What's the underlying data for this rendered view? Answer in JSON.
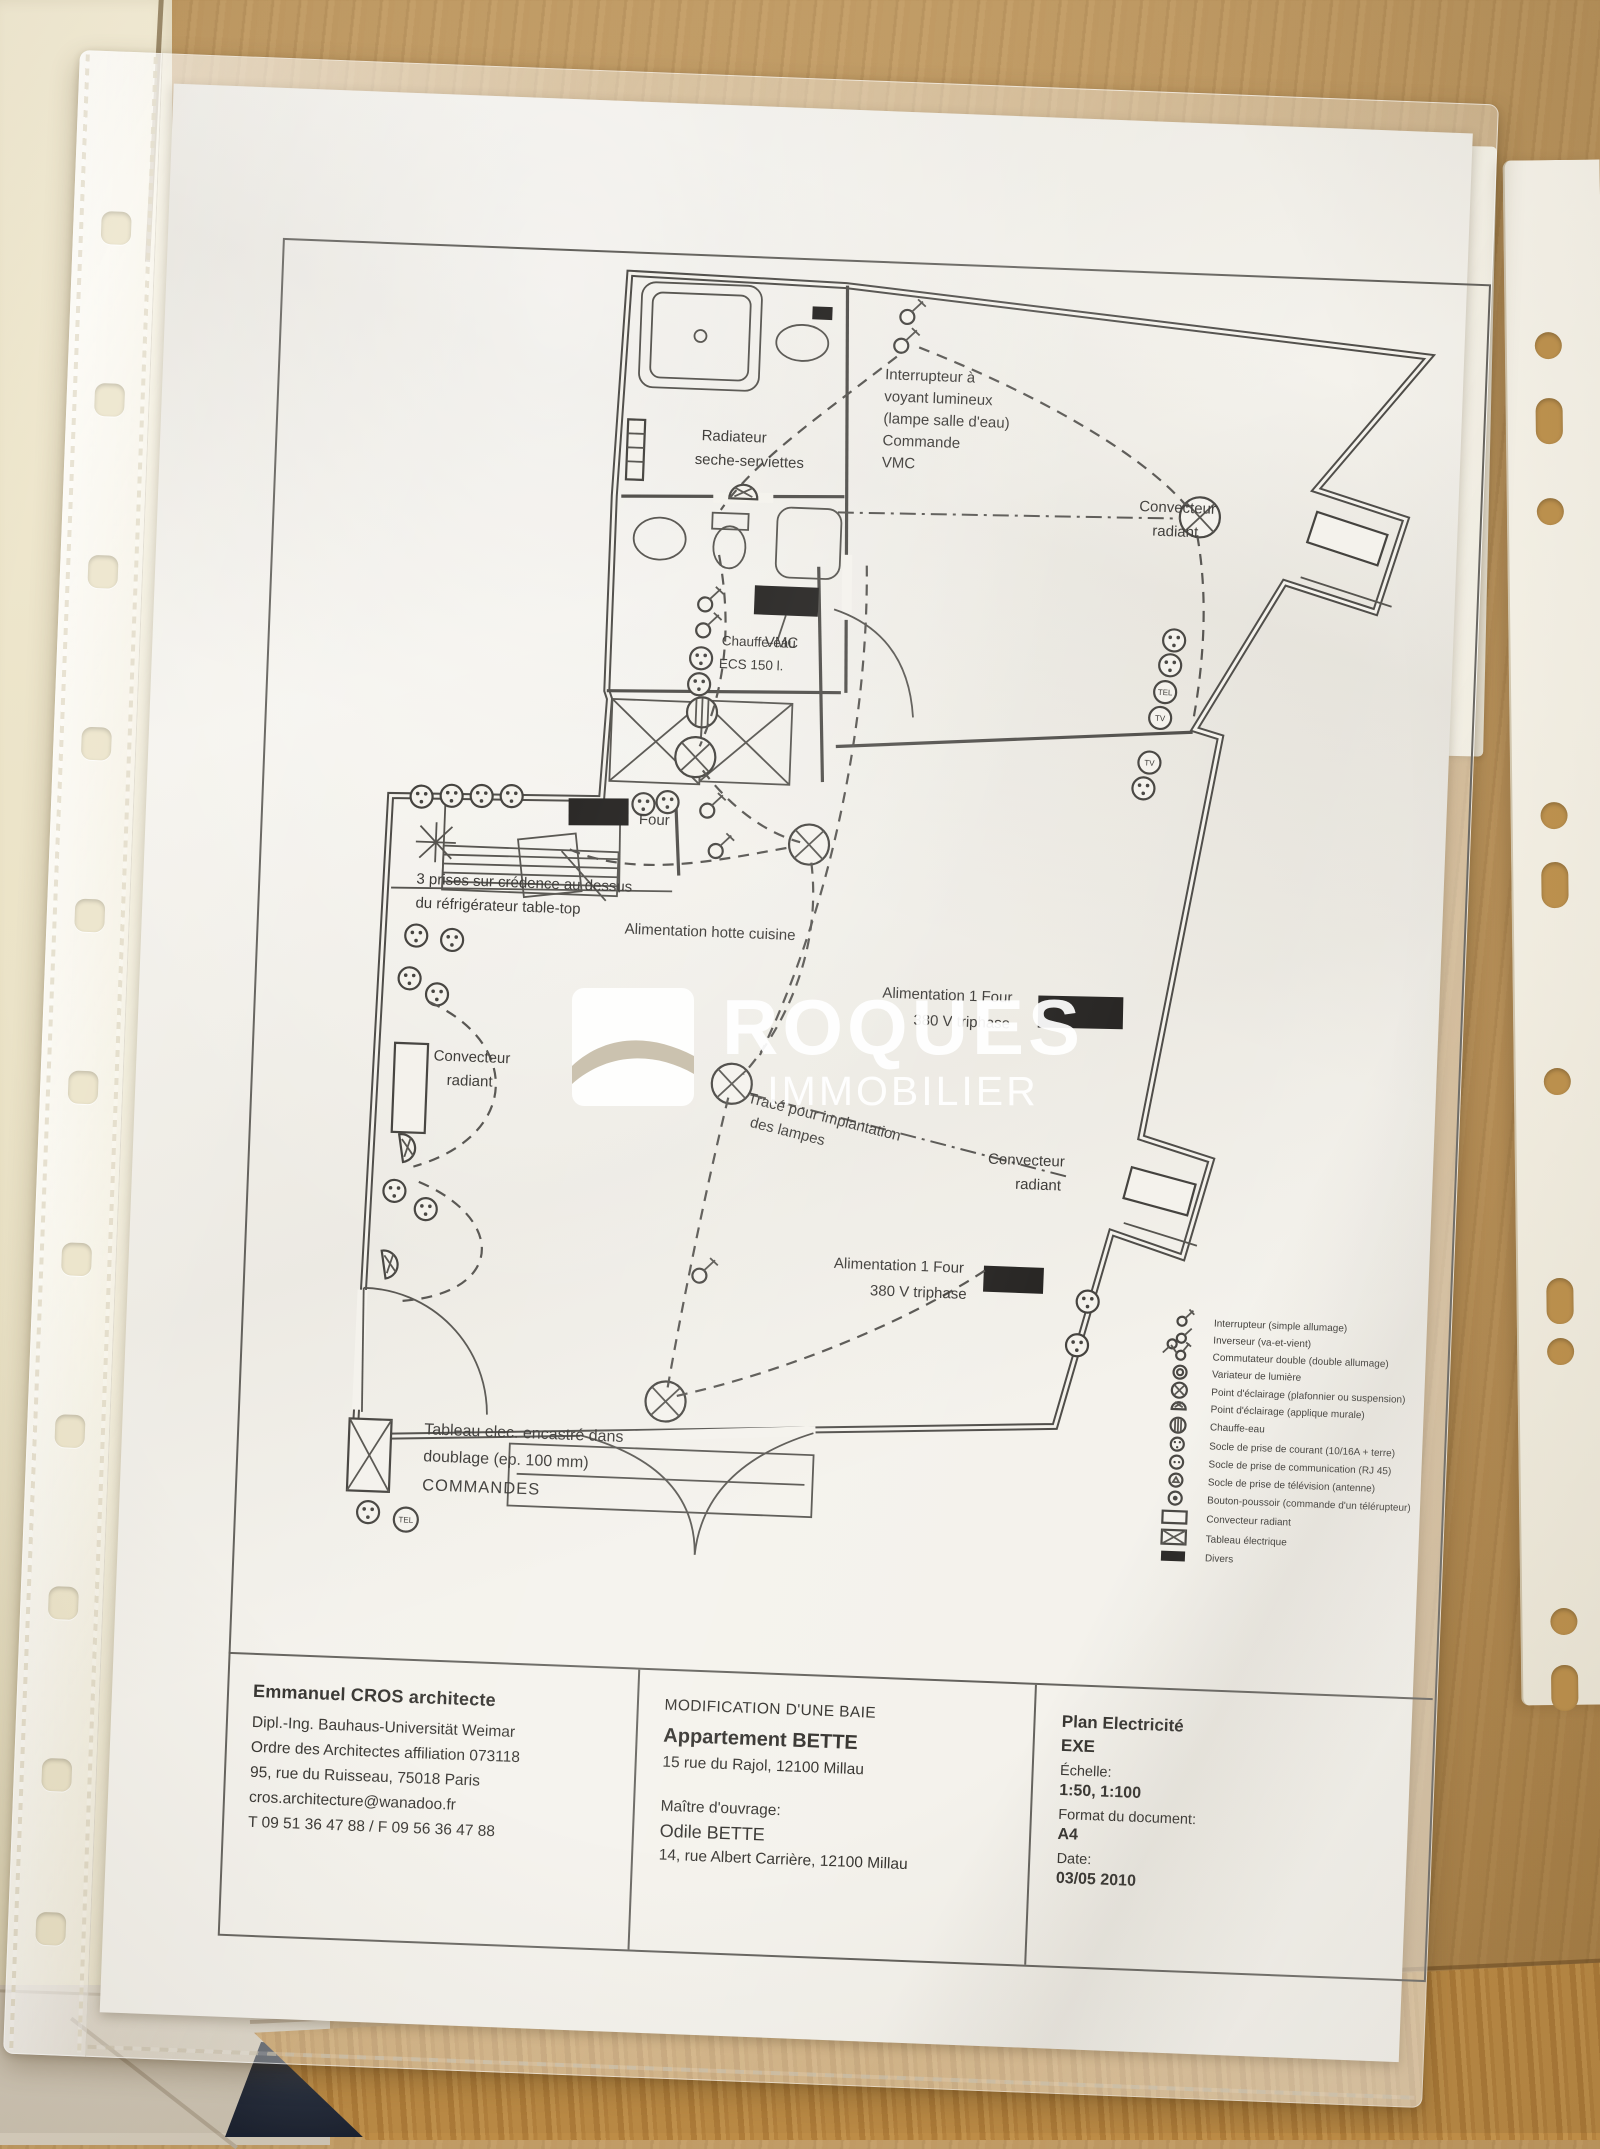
{
  "watermark": {
    "line1": "ROQUES",
    "line2": "IMMOBILIER"
  },
  "plan": {
    "labels": {
      "interrupteur_voyant": [
        "Interrupteur à",
        "voyant lumineux",
        "(lampe salle d'eau)",
        "Commande",
        "VMC"
      ],
      "radiateur": [
        "Radiateur",
        "seche-serviettes"
      ],
      "convecteur_top_right": [
        "Convecteur",
        "radiant"
      ],
      "vmc": "VMC",
      "chauffe_eau": [
        "Chauffe-eau",
        "ECS 150 l."
      ],
      "four": "Four",
      "prises_credence": [
        "3 prises sur crédence au dessus",
        "du réfrigérateur table-top"
      ],
      "hotte": "Alimentation hotte cuisine",
      "alim_four_1": [
        "Alimentation 1 Four",
        "380 V triphase"
      ],
      "convecteur_left": [
        "Convecteur",
        "radiant"
      ],
      "trace_lampes": [
        "Tracé pour implantation",
        "des lampes"
      ],
      "convecteur_mid_right": [
        "Convecteur",
        "radiant"
      ],
      "alim_four_2": [
        "Alimentation 1 Four",
        "380 V triphase"
      ],
      "tableau_elec": [
        "Tableau elec. encastré dans",
        "doublage (ep. 100 mm)",
        "COMMANDES"
      ],
      "tel": "TEL",
      "tv": "TV"
    }
  },
  "legend": {
    "items": [
      {
        "symbol": "interrupteur-simple",
        "label": "Interrupteur (simple allumage)"
      },
      {
        "symbol": "inverseur",
        "label": "Inverseur (va-et-vient)"
      },
      {
        "symbol": "commutateur-double",
        "label": "Commutateur double (double allumage)"
      },
      {
        "symbol": "variateur",
        "label": "Variateur de lumière"
      },
      {
        "symbol": "point-eclairage-plafonnier",
        "label": "Point d'éclairage (plafonnier ou suspension)"
      },
      {
        "symbol": "point-eclairage-applique",
        "label": "Point d'éclairage (applique murale)"
      },
      {
        "symbol": "chauffe-eau",
        "label": "Chauffe-eau"
      },
      {
        "symbol": "prise-courant",
        "label": "Socle de prise de courant (10/16A + terre)"
      },
      {
        "symbol": "prise-communication",
        "label": "Socle de prise de communication (RJ 45)"
      },
      {
        "symbol": "prise-television",
        "label": "Socle de prise de télévision (antenne)"
      },
      {
        "symbol": "bouton-poussoir",
        "label": "Bouton-poussoir (commande d'un télérupteur)"
      },
      {
        "symbol": "convecteur-radiant",
        "label": "Convecteur radiant"
      },
      {
        "symbol": "tableau-electrique",
        "label": "Tableau électrique"
      },
      {
        "symbol": "divers",
        "label": "Divers"
      }
    ]
  },
  "title_block": {
    "architect": {
      "name": "Emmanuel CROS architecte",
      "line1": "Dipl.-Ing. Bauhaus-Universität Weimar",
      "line2": "Ordre des Architectes affiliation 073118",
      "line3": "95, rue du Ruisseau, 75018 Paris",
      "line4": "cros.architecture@wanadoo.fr",
      "line5": "T 09 51 36 47 88 / F 09 56 36 47 88"
    },
    "project": {
      "operation": "MODIFICATION D'UNE BAIE",
      "name": "Appartement BETTE",
      "address": "15 rue du Rajol, 12100 Millau",
      "client_label": "Maître d'ouvrage:",
      "client_name": "Odile BETTE",
      "client_address": "14, rue Albert Carrière, 12100 Millau"
    },
    "doc": {
      "title": "Plan Electricité",
      "phase": "EXE",
      "scale_label": "Échelle:",
      "scale": "1:50, 1:100",
      "format_label": "Format du document:",
      "format": "A4",
      "date_label": "Date:",
      "date": "03/05 2010"
    }
  }
}
